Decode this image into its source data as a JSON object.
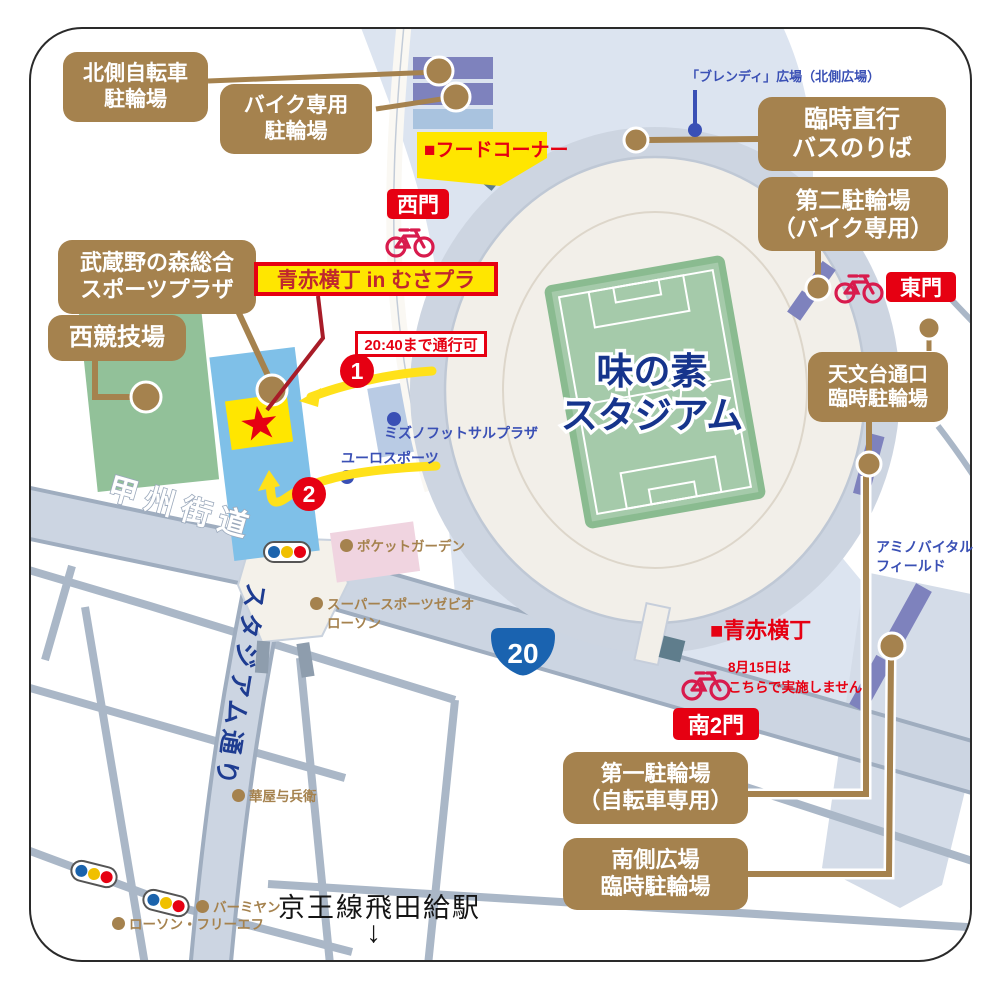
{
  "labels": {
    "north_bicycle": {
      "l1": "北側自転車",
      "l2": "駐輪場"
    },
    "bike_only": {
      "l1": "バイク専用",
      "l2": "駐輪場"
    },
    "musashino": {
      "l1": "武蔵野の森総合",
      "l2": "スポーツプラザ"
    },
    "west_stadium": {
      "l1": "西競技場"
    },
    "temp_bus": {
      "l1": "臨時直行",
      "l2": "バスのりば"
    },
    "second_parking": {
      "l1": "第二駐輪場",
      "l2": "（バイク専用）"
    },
    "observatory_parking": {
      "l1": "天文台通口",
      "l2": "臨時駐輪場"
    },
    "first_parking": {
      "l1": "第一駐輪場",
      "l2": "（自転車専用）"
    },
    "south_plaza_parking": {
      "l1": "南側広場",
      "l2": "臨時駐輪場"
    }
  },
  "gates": {
    "west": "西門",
    "east": "東門",
    "south2": "南2門"
  },
  "stadium": {
    "name_l1": "味の素",
    "name_l2": "スタジアム"
  },
  "banners": {
    "event": "青赤横丁 in むさプラ",
    "food_corner": "■フードコーナー",
    "yokocho": "■青赤横丁",
    "pass_until": "20:40まで通行可",
    "aug15_l1": "8月15日は",
    "aug15_l2": "こちらで実施しません"
  },
  "blue_texts": {
    "blendy": "「ブレンディ」広場（北側広場）",
    "mizuno": "ミズノフットサルプラザ",
    "euro": "ユーロスポーツ",
    "amino_l1": "アミノバイタル",
    "amino_l2": "フィールド"
  },
  "brown_texts": {
    "pocket": "ポケットガーデン",
    "xebio": "スーパースポーツゼビオ",
    "lawson": "ローソン",
    "hanaya": "華屋与兵衛",
    "bamiyan": "バーミヤン",
    "lawson_ff": "ローソン・フリーエフ"
  },
  "roads": {
    "koshu": "甲州街道",
    "stadium_st": "スタジアム通り",
    "route20": "20"
  },
  "station": {
    "name": "京王線飛田給駅",
    "arrow": "↓"
  },
  "markers": {
    "one": "1",
    "two": "2",
    "star": "★"
  },
  "colors": {
    "label_brown": "#a5824e",
    "red": "#e60012",
    "bike_crimson": "#d81b4d",
    "yellow": "#ffe600",
    "navy": "#16348c",
    "blue_text": "#3a50b5",
    "map_blue": "#dce4f0",
    "road_gray": "#ccd5e2",
    "cream": "#f2efe9",
    "field_green": "#a5caaa",
    "purple_bar": "#7e82bd",
    "tan_band": "#f6e0ac",
    "pink": "#f0d4e0",
    "sky_blue": "#7fc0e8",
    "west_green": "#92c199",
    "route_shield": "#1a63b0"
  }
}
